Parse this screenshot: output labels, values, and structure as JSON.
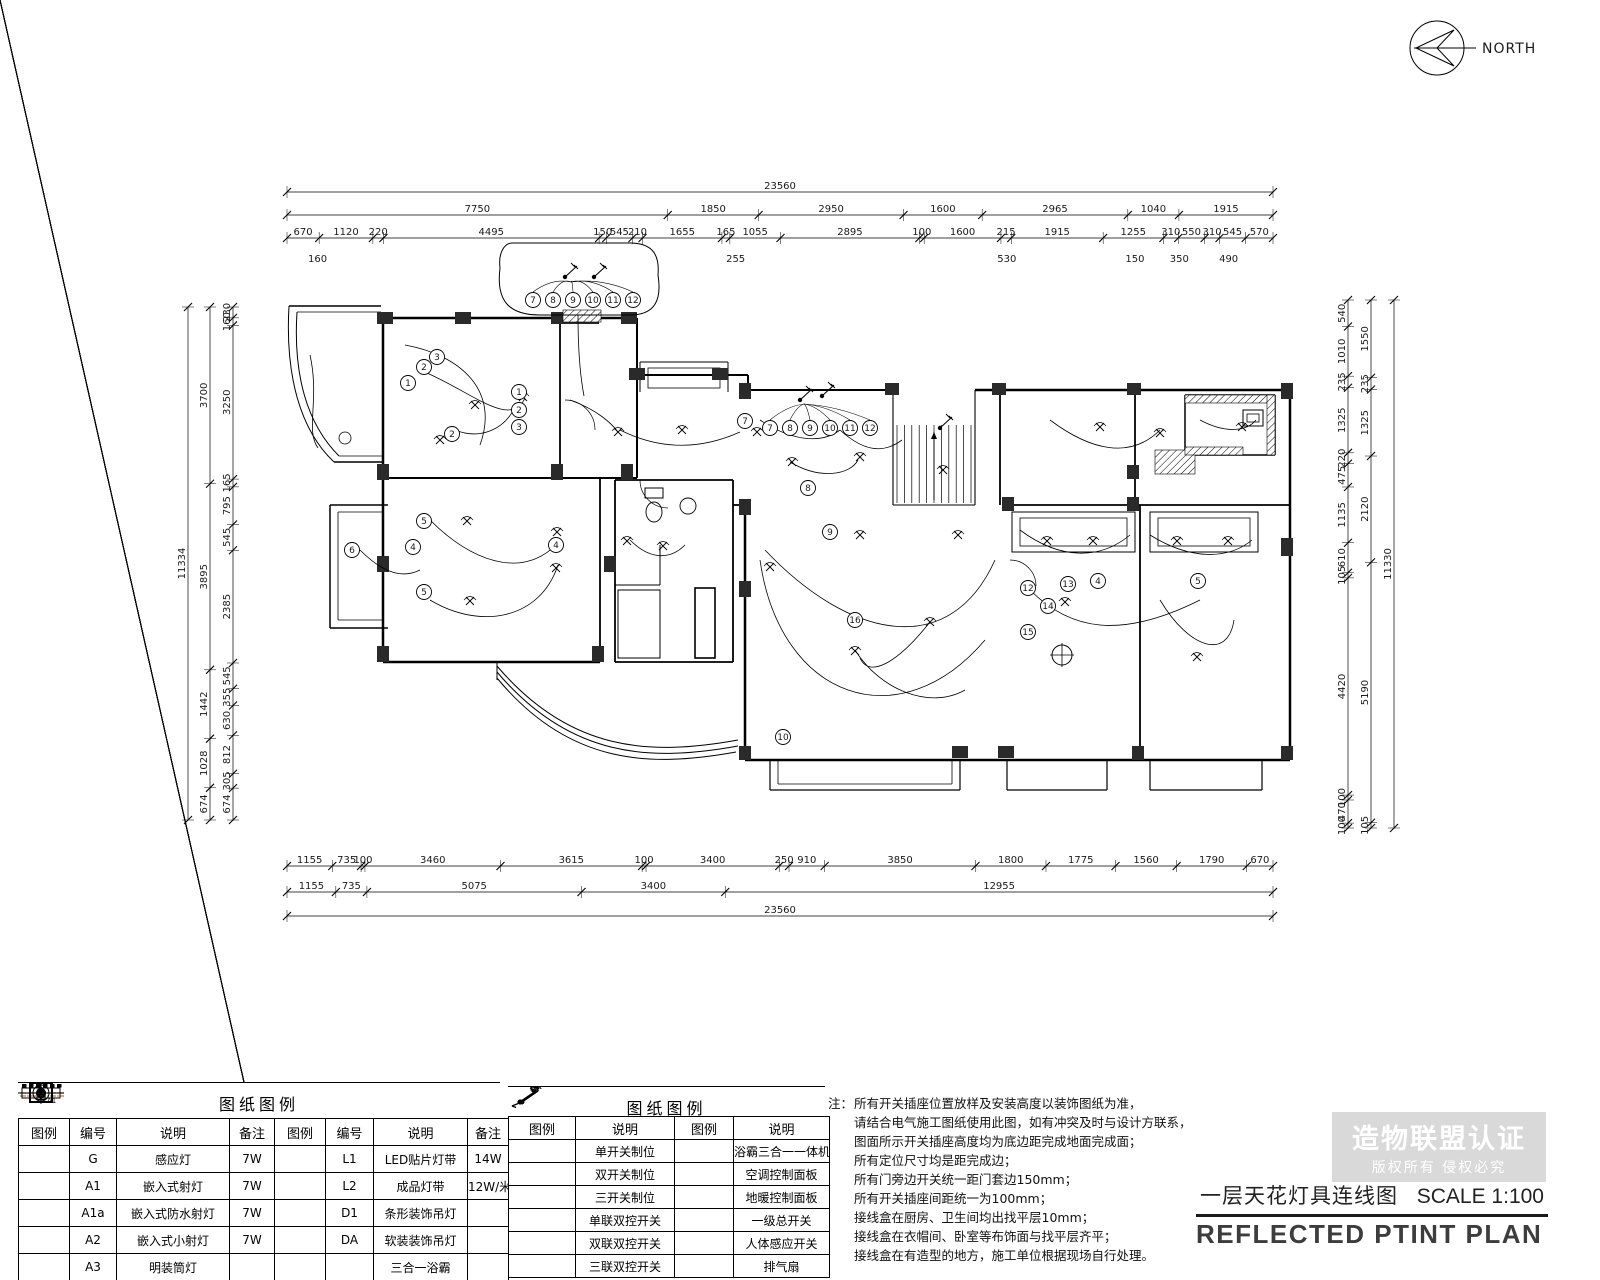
{
  "north": {
    "label": "NORTH"
  },
  "title_block": {
    "title_cn": "一层天花灯具连线图",
    "scale": "SCALE 1:100",
    "title_en": "REFLECTED PTINT PLAN"
  },
  "watermark": {
    "line1": "造物联盟认证",
    "line2": "版权所有 侵权必究"
  },
  "colors": {
    "strip_dash": "#c87c5a",
    "watermark_bg": "#d9d9d9",
    "line": "#000000"
  },
  "legend_left": {
    "title": "图纸图例",
    "headers": [
      "图例",
      "编号",
      "说明",
      "备注",
      "图例",
      "编号",
      "说明",
      "备注"
    ],
    "rows": [
      {
        "sym1": "star",
        "no1": "G",
        "desc1": "感应灯",
        "note1": "7W",
        "sym2": "led-strip",
        "no2": "L1",
        "desc2": "LED贴片灯带",
        "note2": "14W"
      },
      {
        "sym1": "spot-a1",
        "no1": "A1",
        "desc1": "嵌入式射灯",
        "note1": "7W",
        "sym2": "strip",
        "no2": "L2",
        "desc2": "成品灯带",
        "note2": "12W/米"
      },
      {
        "sym1": "spot",
        "no1": "A1a",
        "desc1": "嵌入式防水射灯",
        "note1": "7W",
        "sym2": "bar-pendant",
        "no2": "D1",
        "desc2": "条形装饰吊灯",
        "note2": ""
      },
      {
        "sym1": "spot-small",
        "no1": "A2",
        "desc1": "嵌入式小射灯",
        "note1": "7W",
        "sym2": "pendant-da",
        "no2": "DA",
        "desc2": "软装装饰吊灯",
        "note2": ""
      },
      {
        "sym1": "downlight",
        "no1": "A3",
        "desc1": "明装筒灯",
        "note1": "",
        "sym2": "bath",
        "no2": "",
        "desc2": "三合一浴霸",
        "note2": ""
      }
    ]
  },
  "legend_mid": {
    "title": "图纸图例",
    "headers": [
      "图例",
      "说明",
      "图例",
      "说明"
    ],
    "rows": [
      {
        "sym1": "sw1",
        "desc1": "单开关制位",
        "sym2": "swb",
        "desc2": "浴霸三合一一体机开关"
      },
      {
        "sym1": "sw2",
        "desc1": "双开关制位",
        "sym2": "swac",
        "desc2": "空调控制面板"
      },
      {
        "sym1": "sw3",
        "desc1": "三开关制位",
        "sym2": "swfh",
        "desc2": "地暖控制面板"
      },
      {
        "sym1": "sw1d",
        "desc1": "单联双控开关",
        "sym2": "swmain",
        "desc2": "一级总开关"
      },
      {
        "sym1": "sw2d",
        "desc1": "双联双控开关",
        "sym2": "swsens",
        "desc2": "人体感应开关"
      },
      {
        "sym1": "sw3d",
        "desc1": "三联双控开关",
        "sym2": "none",
        "desc2": "排气扇"
      }
    ]
  },
  "notes": {
    "label": "注：",
    "lines": [
      "所有开关插座位置放样及安装高度以装饰图纸为准，",
      "请结合电气施工图纸使用此图，如有冲突及时与设计方联系，",
      "图面所示开关插座高度均为底边距完成地面完成面；",
      "所有定位尺寸均是距完成边；",
      "所有门旁边开关统一距门套边150mm；",
      "所有开关插座间距统一为100mm；",
      "接线盒在厨房、卫生间均出找平层10mm；",
      "接线盒在衣帽间、卧室等布饰面与找平层齐平；",
      "接线盒在有造型的地方，施工单位根据现场自行处理。"
    ]
  },
  "dimensions": {
    "top_total": [
      "23560"
    ],
    "top_major": [
      "7750",
      "1850",
      "2950",
      "1600",
      "2965",
      "1040",
      "1915"
    ],
    "top_minor": [
      "670",
      "1120",
      "220",
      "4495",
      "150",
      "545",
      "210",
      "1655",
      "165",
      "1055",
      "2895",
      "100",
      "1600",
      "215",
      "1915",
      "1255",
      "310",
      "550",
      "310",
      "545",
      "570"
    ],
    "top_sub": [
      "160",
      "255",
      "530",
      "150",
      "350",
      "490"
    ],
    "bottom_minor": [
      "1155",
      "735",
      "100",
      "3460",
      "3615",
      "100",
      "3400",
      "250",
      "910",
      "3850",
      "1800",
      "1775",
      "1560",
      "1790",
      "670"
    ],
    "bottom_major": [
      "1155",
      "735",
      "5075",
      "3400",
      "12955"
    ],
    "bottom_total": [
      "23560"
    ],
    "left_outer": [
      "11334"
    ],
    "left_mid": [
      "3700",
      "3895",
      "1442",
      "1028",
      "674"
    ],
    "left_inner": [
      "230",
      "160",
      "3250",
      "165",
      "795",
      "545",
      "2385",
      "545",
      "355",
      "630",
      "812",
      "305",
      "674"
    ],
    "right_inner": [
      "540",
      "1010",
      "235",
      "1325",
      "220",
      "475",
      "1135",
      "610",
      "105",
      "4420",
      "100",
      "470",
      "100"
    ],
    "right_mid": [
      "1550",
      "235",
      "1325",
      "2120",
      "5190",
      "105"
    ],
    "right_outer": [
      "11330"
    ]
  },
  "plan": {
    "circled": [
      {
        "n": "7",
        "x": 533,
        "y": 300
      },
      {
        "n": "8",
        "x": 553,
        "y": 300
      },
      {
        "n": "9",
        "x": 573,
        "y": 300
      },
      {
        "n": "10",
        "x": 593,
        "y": 300
      },
      {
        "n": "11",
        "x": 613,
        "y": 300
      },
      {
        "n": "12",
        "x": 633,
        "y": 300
      },
      {
        "n": "7",
        "x": 770,
        "y": 428
      },
      {
        "n": "8",
        "x": 790,
        "y": 428
      },
      {
        "n": "9",
        "x": 810,
        "y": 428
      },
      {
        "n": "10",
        "x": 830,
        "y": 428
      },
      {
        "n": "11",
        "x": 850,
        "y": 428
      },
      {
        "n": "12",
        "x": 870,
        "y": 428
      },
      {
        "n": "1",
        "x": 408,
        "y": 383
      },
      {
        "n": "2",
        "x": 424,
        "y": 367
      },
      {
        "n": "3",
        "x": 437,
        "y": 357
      },
      {
        "n": "1",
        "x": 519,
        "y": 392
      },
      {
        "n": "2",
        "x": 519,
        "y": 410
      },
      {
        "n": "3",
        "x": 519,
        "y": 427
      },
      {
        "n": "2",
        "x": 452,
        "y": 434
      },
      {
        "n": "5",
        "x": 424,
        "y": 521
      },
      {
        "n": "4",
        "x": 413,
        "y": 547
      },
      {
        "n": "5",
        "x": 424,
        "y": 592
      },
      {
        "n": "6",
        "x": 352,
        "y": 550
      },
      {
        "n": "4",
        "x": 556,
        "y": 545
      },
      {
        "n": "7",
        "x": 745,
        "y": 421
      },
      {
        "n": "8",
        "x": 808,
        "y": 488
      },
      {
        "n": "9",
        "x": 830,
        "y": 532
      },
      {
        "n": "16",
        "x": 855,
        "y": 620
      },
      {
        "n": "10",
        "x": 783,
        "y": 737
      },
      {
        "n": "12",
        "x": 1028,
        "y": 588
      },
      {
        "n": "13",
        "x": 1068,
        "y": 584
      },
      {
        "n": "14",
        "x": 1048,
        "y": 606
      },
      {
        "n": "15",
        "x": 1028,
        "y": 632
      },
      {
        "n": "4",
        "x": 1098,
        "y": 581
      },
      {
        "n": "5",
        "x": 1198,
        "y": 581
      }
    ]
  }
}
